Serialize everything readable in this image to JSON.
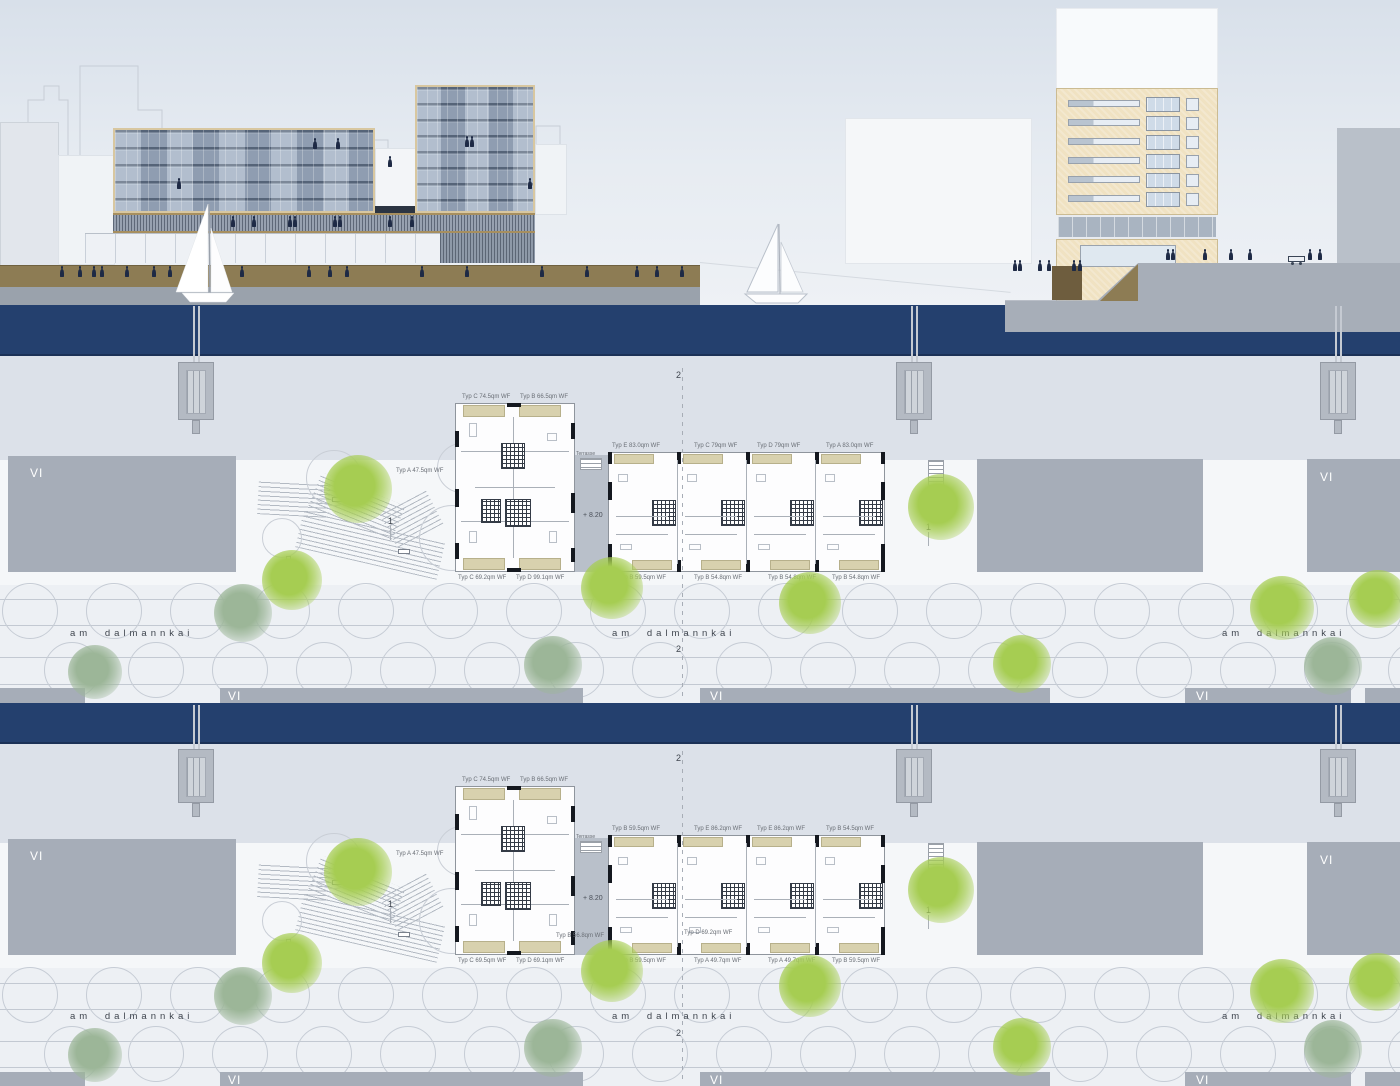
{
  "drawing": {
    "street_name": "am dalmannkai",
    "block_label": "VI",
    "section_marker_primary": "2",
    "section_marker_secondary": "1",
    "level_annotation": "+ 8.20",
    "terrace_annotation": "Terrasse"
  },
  "colors": {
    "water": "#24406E",
    "sky_top": "#D8E0EA",
    "sky_bottom": "#EEF1F5",
    "quay_olive": "#8D7C54",
    "ground_gray": "#9AA2AC",
    "block_gray": "#A6ADB8",
    "pier_gray": "#B4BAC3",
    "facade_glass": "#93A1B4",
    "facade_frame": "#D8C7A0",
    "tower_beige": "#F0E2C2",
    "tree_bright": "#A6CD52",
    "tree_sage": "#9CB698",
    "person_navy": "#1E2A45",
    "plan_white": "#FDFDFE",
    "tan_balcony": "#D8D1AE"
  },
  "elevations": {
    "left": {
      "slab_floors": 5,
      "tower_floors": 8,
      "facade_people": [
        [
          313,
          141
        ],
        [
          336,
          141
        ],
        [
          388,
          159
        ],
        [
          177,
          181
        ],
        [
          465,
          139
        ],
        [
          470,
          139
        ],
        [
          528,
          181
        ]
      ],
      "promenade_people_x": [
        231,
        252,
        288,
        293,
        333,
        338,
        388,
        410
      ],
      "promenade_people_y": 219,
      "quay_people_x": [
        60,
        78,
        92,
        100,
        125,
        152,
        168,
        240,
        307,
        328,
        345,
        420,
        465,
        540,
        585,
        635,
        655,
        680
      ],
      "quay_people_y": 269
    },
    "right": {
      "window_rows": 6,
      "upper_people_x": [
        1166,
        1171,
        1203,
        1229,
        1248,
        1308,
        1318
      ],
      "upper_people_y": 252,
      "lower_people_x": [
        1013,
        1018,
        1038,
        1047,
        1072,
        1078
      ],
      "lower_people_y": 263
    }
  },
  "plan_bands": [
    {
      "tower_plan": {
        "top_labels": [
          "Typ C  74.5qm WF",
          "Typ B  66.5qm WF"
        ],
        "left_label": "Typ A  47.5qm WF",
        "bottom_labels": [
          "Typ C  69.2qm WF",
          "Typ D  99.1qm WF"
        ]
      },
      "slab_plan": {
        "top_labels": [
          "Typ E  83.0qm WF",
          "Typ C  79qm WF",
          "Typ D  79qm WF",
          "Typ A  83.0qm WF"
        ],
        "bottom_labels": [
          "Typ B  59.5qm WF",
          "Typ B  54.8qm WF",
          "Typ B  54.8qm WF",
          "Typ B  54.8qm WF"
        ]
      },
      "trees": [
        [
          358,
          489,
          34,
          "bright"
        ],
        [
          292,
          580,
          30,
          "bright"
        ],
        [
          612,
          588,
          31,
          "bright"
        ],
        [
          810,
          603,
          31,
          "bright"
        ],
        [
          941,
          507,
          33,
          "bright"
        ],
        [
          1022,
          664,
          29,
          "bright"
        ],
        [
          1282,
          608,
          32,
          "bright"
        ],
        [
          1378,
          599,
          29,
          "bright"
        ],
        [
          243,
          613,
          29,
          "sage"
        ],
        [
          95,
          672,
          27,
          "sage"
        ],
        [
          553,
          665,
          29,
          "sage"
        ],
        [
          1333,
          666,
          29,
          "sage"
        ]
      ]
    },
    {
      "tower_plan": {
        "top_labels": [
          "Typ C  74.5qm WF",
          "Typ B  66.5qm WF"
        ],
        "left_label": "Typ A  47.5qm WF",
        "bottom_labels": [
          "Typ C  69.5qm WF",
          "Typ D  69.1qm WF"
        ]
      },
      "slab_plan": {
        "top_labels": [
          "Typ B  59.5qm WF",
          "Typ E  86.2qm WF",
          "Typ E  86.2qm WF",
          "Typ B  54.5qm WF"
        ],
        "bottom_labels": [
          "Typ B  59.5qm WF",
          "Typ A  49.7qm WF",
          "Typ A  49.7qm WF",
          "Typ B  59.5qm WF"
        ],
        "interior_label": "Typ D  69.2qm WF"
      },
      "gap_extra_label": "Typ B  56.8qm WF",
      "trees": [
        [
          358,
          872,
          34,
          "bright"
        ],
        [
          292,
          963,
          30,
          "bright"
        ],
        [
          612,
          971,
          31,
          "bright"
        ],
        [
          810,
          986,
          31,
          "bright"
        ],
        [
          941,
          890,
          33,
          "bright"
        ],
        [
          1022,
          1047,
          29,
          "bright"
        ],
        [
          1282,
          991,
          32,
          "bright"
        ],
        [
          1378,
          982,
          29,
          "bright"
        ],
        [
          243,
          996,
          29,
          "sage"
        ],
        [
          95,
          1055,
          27,
          "sage"
        ],
        [
          553,
          1048,
          29,
          "sage"
        ],
        [
          1333,
          1049,
          29,
          "sage"
        ]
      ]
    }
  ]
}
